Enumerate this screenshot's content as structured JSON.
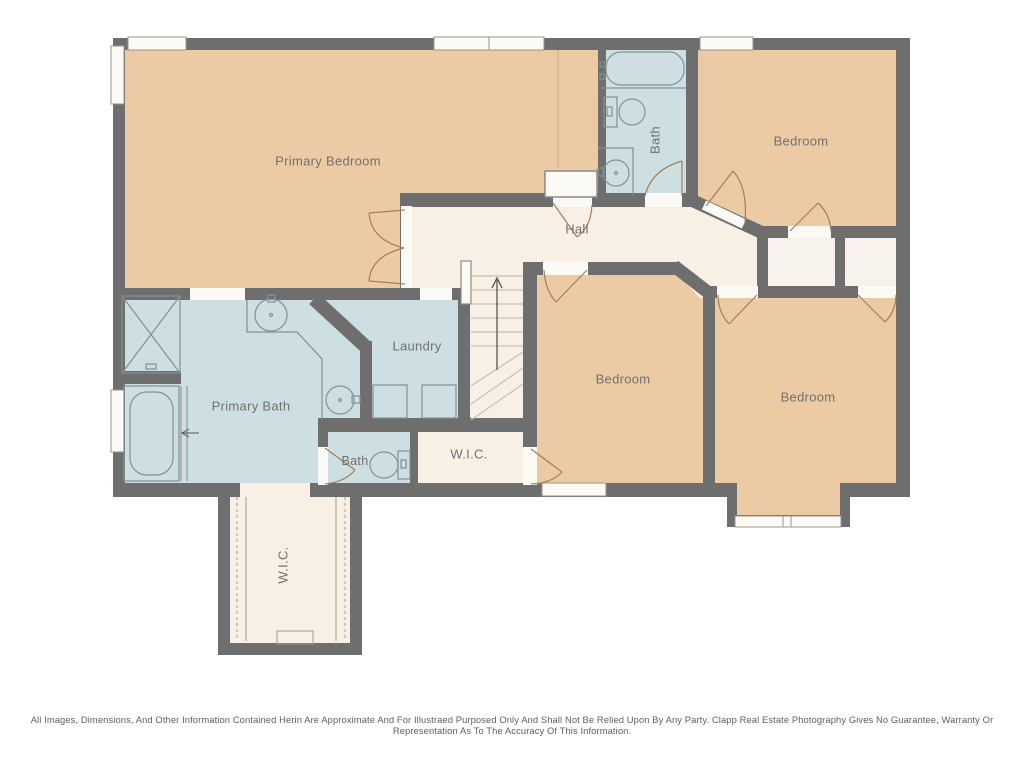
{
  "rooms": {
    "primary_bedroom": {
      "label": "Primary Bedroom"
    },
    "bath_upper": {
      "label": "Bath"
    },
    "bedroom_upper_right": {
      "label": "Bedroom"
    },
    "hall": {
      "label": "Hall"
    },
    "laundry": {
      "label": "Laundry"
    },
    "primary_bath": {
      "label": "Primary Bath"
    },
    "bedroom_middle": {
      "label": "Bedroom"
    },
    "bedroom_lower_right": {
      "label": "Bedroom"
    },
    "bath_lower": {
      "label": "Bath"
    },
    "wic_center": {
      "label": "W.I.C."
    },
    "wic_lower": {
      "label": "W.I.C."
    }
  },
  "footer": {
    "disclaimer": "All Images, Dimensions, And Other Information Contained Herin Are Approximate And For Illustraed Purposed Only And Shall Not Be Relied Upon By Any Party. Clapp Real Estate Photography Gives No Guarantee, Warranty Or Representation As To The Accuracy Of This Information."
  },
  "colors": {
    "background": "#ffffff",
    "wall": "#6e6e6e",
    "bedroom": "#eccaa4",
    "hall": "#f8f0e5",
    "bath": "#cddfe2",
    "closet": "#f7f2ec",
    "window": "#fcfaf5",
    "window_border": "#9a948a",
    "door": "#a87c54",
    "fixture": "#7e929a",
    "stair_line": "#c6bfb2",
    "wardrobe_line": "#a89a88",
    "label": "#717171",
    "disclaimer": "#5e5e5e"
  }
}
